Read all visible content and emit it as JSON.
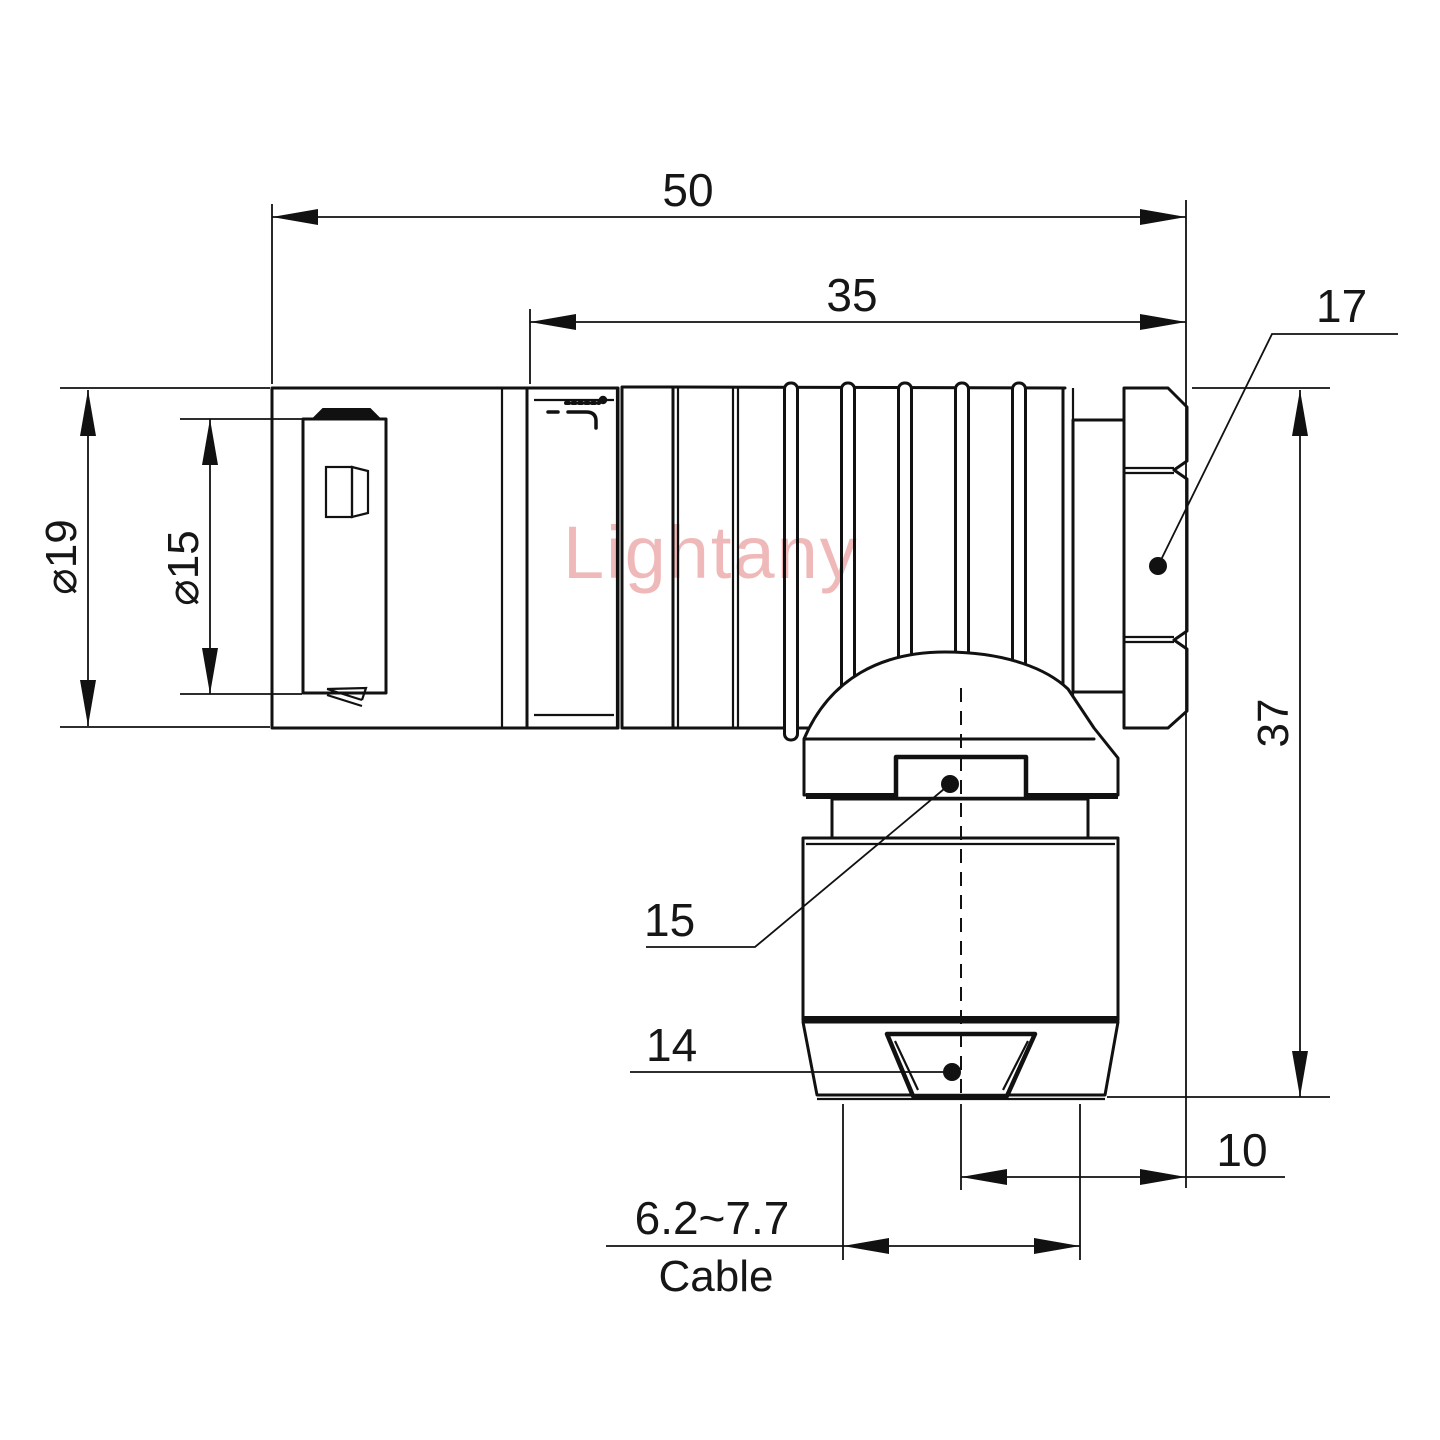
{
  "watermark": "Lightany",
  "dimensions": {
    "overall_length": "50",
    "body_length": "35",
    "hex_flats": "17",
    "diameter_outer": "⌀19",
    "diameter_inner": "⌀15",
    "height": "37",
    "gland_upper": "15",
    "gland_lower": "14",
    "exit_offset": "10",
    "cable_range": "6.2~7.7",
    "cable_label": "Cable"
  }
}
